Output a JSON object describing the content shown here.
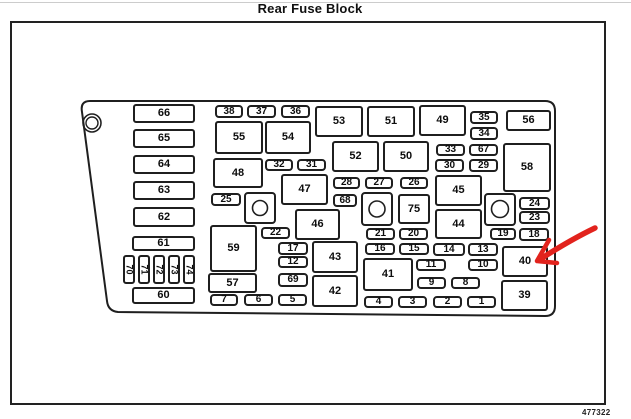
{
  "title": "Rear Fuse Block",
  "figure_number": "477322",
  "colors": {
    "background": "#ffffff",
    "line": "#1f1f1f",
    "arrow_red": "#e2231d"
  },
  "annotation": {
    "arrow_points_to_fuse": "40"
  },
  "diagram": {
    "fuses": [
      {
        "label": "66",
        "x": 133,
        "y": 104,
        "w": 62,
        "h": 19,
        "type": "lg"
      },
      {
        "label": "65",
        "x": 133,
        "y": 129,
        "w": 62,
        "h": 19,
        "type": "lg"
      },
      {
        "label": "64",
        "x": 133,
        "y": 155,
        "w": 62,
        "h": 19,
        "type": "lg"
      },
      {
        "label": "63",
        "x": 133,
        "y": 181,
        "w": 62,
        "h": 19,
        "type": "lg"
      },
      {
        "label": "62",
        "x": 133,
        "y": 207,
        "w": 62,
        "h": 20,
        "type": "lg"
      },
      {
        "label": "61",
        "x": 132,
        "y": 236,
        "w": 63,
        "h": 15,
        "type": "lg"
      },
      {
        "label": "60",
        "x": 132,
        "y": 287,
        "w": 63,
        "h": 17,
        "type": "lg"
      },
      {
        "label": "70",
        "x": 123,
        "y": 255,
        "w": 12,
        "h": 29,
        "type": "v"
      },
      {
        "label": "71",
        "x": 138,
        "y": 255,
        "w": 12,
        "h": 29,
        "type": "v"
      },
      {
        "label": "72",
        "x": 153,
        "y": 255,
        "w": 12,
        "h": 29,
        "type": "v"
      },
      {
        "label": "73",
        "x": 168,
        "y": 255,
        "w": 12,
        "h": 29,
        "type": "v"
      },
      {
        "label": "74",
        "x": 183,
        "y": 255,
        "w": 12,
        "h": 29,
        "type": "v"
      },
      {
        "label": "38",
        "x": 215,
        "y": 105,
        "w": 28,
        "h": 13,
        "type": "sm"
      },
      {
        "label": "37",
        "x": 247,
        "y": 105,
        "w": 29,
        "h": 13,
        "type": "sm"
      },
      {
        "label": "36",
        "x": 281,
        "y": 105,
        "w": 29,
        "h": 13,
        "type": "sm"
      },
      {
        "label": "55",
        "x": 215,
        "y": 121,
        "w": 48,
        "h": 33,
        "type": "md"
      },
      {
        "label": "54",
        "x": 265,
        "y": 121,
        "w": 46,
        "h": 33,
        "type": "md"
      },
      {
        "label": "48",
        "x": 213,
        "y": 158,
        "w": 50,
        "h": 30,
        "type": "md"
      },
      {
        "label": "32",
        "x": 265,
        "y": 159,
        "w": 28,
        "h": 12,
        "type": "sm"
      },
      {
        "label": "31",
        "x": 297,
        "y": 159,
        "w": 29,
        "h": 12,
        "type": "sm"
      },
      {
        "label": "47",
        "x": 281,
        "y": 174,
        "w": 47,
        "h": 31,
        "type": "md"
      },
      {
        "label": "25",
        "x": 211,
        "y": 193,
        "w": 30,
        "h": 13,
        "type": "sm"
      },
      {
        "label": "46",
        "x": 295,
        "y": 209,
        "w": 45,
        "h": 31,
        "type": "md"
      },
      {
        "label": "22",
        "x": 261,
        "y": 227,
        "w": 29,
        "h": 12,
        "type": "sm"
      },
      {
        "label": "59",
        "x": 210,
        "y": 225,
        "w": 47,
        "h": 47,
        "type": "md"
      },
      {
        "label": "57",
        "x": 208,
        "y": 273,
        "w": 49,
        "h": 20,
        "type": "md"
      },
      {
        "label": "17",
        "x": 278,
        "y": 242,
        "w": 30,
        "h": 13,
        "type": "sm"
      },
      {
        "label": "12",
        "x": 278,
        "y": 256,
        "w": 30,
        "h": 12,
        "type": "sm"
      },
      {
        "label": "69",
        "x": 278,
        "y": 273,
        "w": 30,
        "h": 14,
        "type": "sm"
      },
      {
        "label": "43",
        "x": 312,
        "y": 241,
        "w": 46,
        "h": 32,
        "type": "md"
      },
      {
        "label": "42",
        "x": 312,
        "y": 275,
        "w": 46,
        "h": 32,
        "type": "md"
      },
      {
        "label": "7",
        "x": 210,
        "y": 294,
        "w": 28,
        "h": 12,
        "type": "sm"
      },
      {
        "label": "6",
        "x": 244,
        "y": 294,
        "w": 29,
        "h": 12,
        "type": "sm"
      },
      {
        "label": "5",
        "x": 278,
        "y": 294,
        "w": 29,
        "h": 12,
        "type": "sm"
      },
      {
        "label": "53",
        "x": 315,
        "y": 106,
        "w": 48,
        "h": 31,
        "type": "md"
      },
      {
        "label": "51",
        "x": 367,
        "y": 106,
        "w": 48,
        "h": 31,
        "type": "md"
      },
      {
        "label": "49",
        "x": 419,
        "y": 105,
        "w": 47,
        "h": 31,
        "type": "md"
      },
      {
        "label": "52",
        "x": 332,
        "y": 141,
        "w": 47,
        "h": 31,
        "type": "md"
      },
      {
        "label": "50",
        "x": 383,
        "y": 141,
        "w": 46,
        "h": 31,
        "type": "md"
      },
      {
        "label": "28",
        "x": 333,
        "y": 177,
        "w": 27,
        "h": 12,
        "type": "sm"
      },
      {
        "label": "27",
        "x": 365,
        "y": 177,
        "w": 28,
        "h": 12,
        "type": "sm"
      },
      {
        "label": "26",
        "x": 400,
        "y": 177,
        "w": 28,
        "h": 12,
        "type": "sm"
      },
      {
        "label": "68",
        "x": 333,
        "y": 194,
        "w": 24,
        "h": 13,
        "type": "sm"
      },
      {
        "label": "75",
        "x": 398,
        "y": 194,
        "w": 32,
        "h": 30,
        "type": "md"
      },
      {
        "label": "45",
        "x": 435,
        "y": 175,
        "w": 47,
        "h": 31,
        "type": "md"
      },
      {
        "label": "44",
        "x": 435,
        "y": 209,
        "w": 47,
        "h": 30,
        "type": "md"
      },
      {
        "label": "21",
        "x": 366,
        "y": 228,
        "w": 29,
        "h": 12,
        "type": "sm"
      },
      {
        "label": "20",
        "x": 399,
        "y": 228,
        "w": 29,
        "h": 12,
        "type": "sm"
      },
      {
        "label": "16",
        "x": 365,
        "y": 243,
        "w": 30,
        "h": 12,
        "type": "sm"
      },
      {
        "label": "15",
        "x": 399,
        "y": 243,
        "w": 30,
        "h": 12,
        "type": "sm"
      },
      {
        "label": "14",
        "x": 433,
        "y": 243,
        "w": 32,
        "h": 13,
        "type": "sm"
      },
      {
        "label": "13",
        "x": 468,
        "y": 243,
        "w": 30,
        "h": 13,
        "type": "sm"
      },
      {
        "label": "41",
        "x": 363,
        "y": 258,
        "w": 50,
        "h": 33,
        "type": "md"
      },
      {
        "label": "11",
        "x": 416,
        "y": 259,
        "w": 30,
        "h": 12,
        "type": "sm"
      },
      {
        "label": "10",
        "x": 468,
        "y": 259,
        "w": 30,
        "h": 12,
        "type": "sm"
      },
      {
        "label": "9",
        "x": 417,
        "y": 277,
        "w": 29,
        "h": 12,
        "type": "sm"
      },
      {
        "label": "8",
        "x": 451,
        "y": 277,
        "w": 29,
        "h": 12,
        "type": "sm"
      },
      {
        "label": "4",
        "x": 364,
        "y": 296,
        "w": 29,
        "h": 12,
        "type": "sm"
      },
      {
        "label": "3",
        "x": 398,
        "y": 296,
        "w": 29,
        "h": 12,
        "type": "sm"
      },
      {
        "label": "2",
        "x": 433,
        "y": 296,
        "w": 29,
        "h": 12,
        "type": "sm"
      },
      {
        "label": "1",
        "x": 467,
        "y": 296,
        "w": 29,
        "h": 12,
        "type": "sm"
      },
      {
        "label": "35",
        "x": 470,
        "y": 111,
        "w": 28,
        "h": 13,
        "type": "sm"
      },
      {
        "label": "34",
        "x": 470,
        "y": 127,
        "w": 28,
        "h": 13,
        "type": "sm"
      },
      {
        "label": "56",
        "x": 506,
        "y": 110,
        "w": 45,
        "h": 21,
        "type": "md"
      },
      {
        "label": "33",
        "x": 436,
        "y": 144,
        "w": 29,
        "h": 12,
        "type": "sm"
      },
      {
        "label": "67",
        "x": 469,
        "y": 144,
        "w": 29,
        "h": 12,
        "type": "sm"
      },
      {
        "label": "30",
        "x": 435,
        "y": 159,
        "w": 29,
        "h": 13,
        "type": "sm"
      },
      {
        "label": "29",
        "x": 469,
        "y": 159,
        "w": 29,
        "h": 13,
        "type": "sm"
      },
      {
        "label": "58",
        "x": 503,
        "y": 143,
        "w": 48,
        "h": 49,
        "type": "md"
      },
      {
        "label": "24",
        "x": 519,
        "y": 197,
        "w": 31,
        "h": 13,
        "type": "sm"
      },
      {
        "label": "23",
        "x": 519,
        "y": 211,
        "w": 31,
        "h": 13,
        "type": "sm"
      },
      {
        "label": "19",
        "x": 490,
        "y": 228,
        "w": 26,
        "h": 12,
        "type": "sm"
      },
      {
        "label": "18",
        "x": 519,
        "y": 228,
        "w": 30,
        "h": 13,
        "type": "sm"
      },
      {
        "label": "40",
        "x": 502,
        "y": 246,
        "w": 46,
        "h": 31,
        "type": "md"
      },
      {
        "label": "39",
        "x": 501,
        "y": 280,
        "w": 47,
        "h": 31,
        "type": "md"
      }
    ]
  }
}
